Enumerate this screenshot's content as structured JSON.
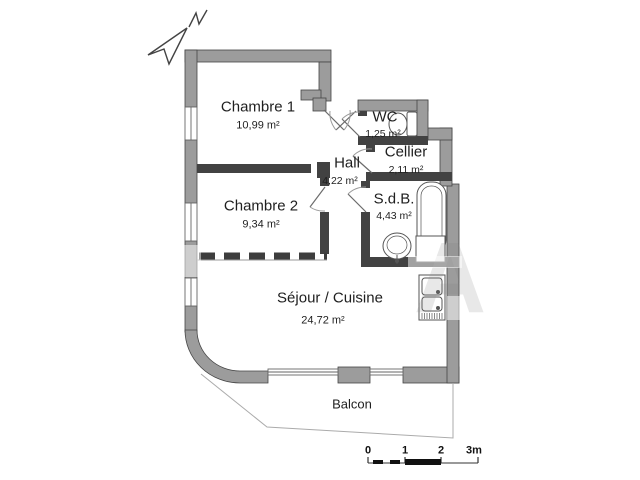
{
  "rooms": {
    "chambre1": {
      "name": "Chambre 1",
      "area": "10,99 m²"
    },
    "chambre2": {
      "name": "Chambre 2",
      "area": "9,34 m²"
    },
    "hall": {
      "name": "Hall",
      "area": "4,22 m²"
    },
    "wc": {
      "name": "WC",
      "area": "1,25 m²"
    },
    "cellier": {
      "name": "Cellier",
      "area": "2,11 m²"
    },
    "sdb": {
      "name": "S.d.B.",
      "area": "4,43 m²"
    },
    "sejour": {
      "name": "Séjour / Cuisine",
      "area": "24,72 m²"
    },
    "balcon": {
      "name": "Balcon"
    }
  },
  "scale_bar": {
    "labels": {
      "l0": "0",
      "l1": "1",
      "l2": "2",
      "l3": "3m"
    }
  },
  "watermark": {
    "letter": "A"
  },
  "icons": [
    "north-arrow-icon",
    "toilet-icon",
    "bathtub-icon",
    "washbasin-icon",
    "washing-machine-icon",
    "kitchen-sink-icon"
  ],
  "colors": {
    "exterior_wall": "#9c9c9c",
    "interior_wall": "#424242",
    "wall_outline": "#454545",
    "thin_line": "#8f8f8f",
    "text": "#1f1f1f",
    "background": "#ffffff"
  }
}
